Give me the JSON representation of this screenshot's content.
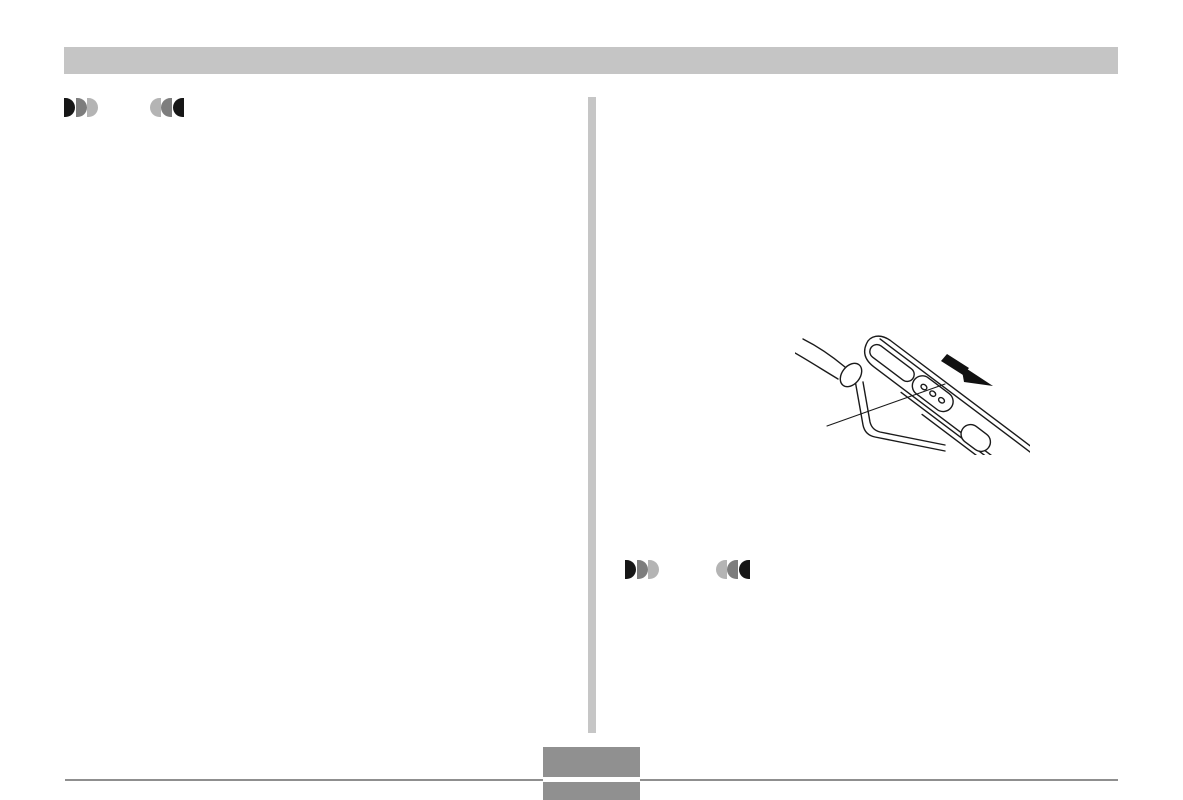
{
  "page": {
    "background": "#ffffff"
  },
  "header": {
    "bar_color": "#c5c5c5"
  },
  "divider": {
    "color": "#c6c6c6"
  },
  "icons": {
    "fast_forward_colors": [
      "#161616",
      "#7d7d7d",
      "#b4b4b4"
    ],
    "rewind_colors": [
      "#b4b4b4",
      "#7d7d7d",
      "#161616"
    ]
  },
  "figure": {
    "line_color": "#1a1a1a",
    "elements": [
      "strap-cord",
      "strap-lug",
      "device-top-edge",
      "slot-opening",
      "slide-switch-with-three-dots",
      "oval-button",
      "callout-line",
      "slide-direction-arrow"
    ]
  },
  "footer": {
    "rule_color": "#8f8f8f",
    "page_box_color": "#909090"
  }
}
